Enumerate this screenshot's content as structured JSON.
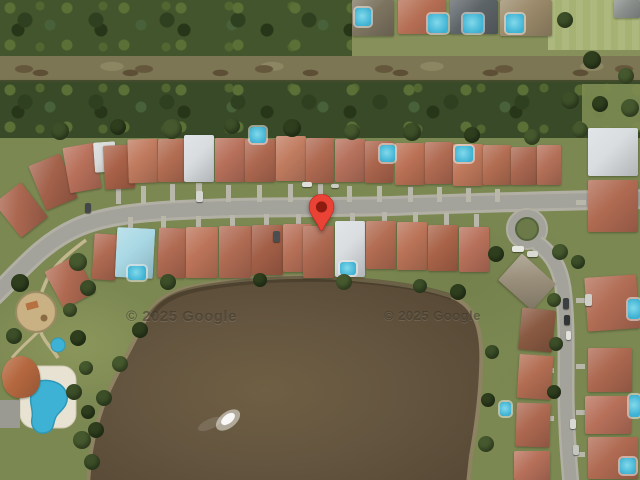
{
  "map": {
    "kind": "google-satellite-view",
    "attribution_left": "© 2025 Google",
    "attribution_right": "© 2025 Google"
  },
  "marker": {
    "name": "location-pin",
    "x": 306,
    "y": 193,
    "width": 31,
    "height": 44,
    "body_color": "#EA4335",
    "outline_color": "#C5221F",
    "dot_color": "#8E1B0F"
  },
  "palette": {
    "grass": "#7c8852",
    "water_mid": "#645540",
    "shore": "#8d8262",
    "road": "#a3a29b",
    "road_edge": "#b2b0a4",
    "driveway": "#b9b6aa",
    "pool": "#3eb2d4",
    "roof_terracotta": "#b06a52",
    "roof_white": "#d9dde0"
  },
  "scene": {
    "houses": [
      [
        4,
        188,
        34,
        44,
        -38,
        "#ab6750"
      ],
      [
        36,
        158,
        34,
        48,
        -22,
        "#a3614a"
      ],
      [
        66,
        145,
        32,
        46,
        -10,
        "#b8705a"
      ],
      [
        94,
        142,
        22,
        30,
        -4,
        "#d6d9d8"
      ],
      [
        104,
        145,
        30,
        44,
        -3,
        "#a96148"
      ],
      [
        128,
        139,
        30,
        44,
        -2,
        "#c07a5e"
      ],
      [
        158,
        139,
        28,
        43,
        0,
        "#b26d52"
      ],
      [
        184,
        135,
        30,
        47,
        0,
        "#d8dcdf"
      ],
      [
        215,
        138,
        30,
        44,
        0,
        "#b7705a"
      ],
      [
        245,
        139,
        30,
        43,
        0,
        "#ad6850"
      ],
      [
        276,
        136,
        30,
        45,
        0,
        "#c17c60"
      ],
      [
        306,
        138,
        28,
        45,
        0,
        "#b06a52"
      ],
      [
        335,
        139,
        30,
        43,
        0,
        "#b5705b"
      ],
      [
        365,
        141,
        28,
        42,
        0,
        "#ab654d"
      ],
      [
        395,
        143,
        30,
        42,
        0,
        "#bb7155"
      ],
      [
        425,
        142,
        28,
        42,
        0,
        "#b06a52"
      ],
      [
        453,
        144,
        30,
        42,
        0,
        "#c0795c"
      ],
      [
        483,
        145,
        28,
        40,
        0,
        "#b26d52"
      ],
      [
        511,
        147,
        26,
        38,
        0,
        "#a96750"
      ],
      [
        537,
        145,
        24,
        40,
        0,
        "#b47058"
      ],
      [
        588,
        128,
        50,
        48,
        0,
        "#d9dde0"
      ],
      [
        93,
        234,
        24,
        46,
        4,
        "#b06a52"
      ],
      [
        116,
        228,
        38,
        50,
        3,
        "#a8d8e4"
      ],
      [
        158,
        228,
        28,
        50,
        2,
        "#b06a52"
      ],
      [
        186,
        227,
        32,
        51,
        0,
        "#bc7459"
      ],
      [
        219,
        226,
        32,
        52,
        0,
        "#b06b53"
      ],
      [
        252,
        225,
        31,
        50,
        0,
        "#a35f47"
      ],
      [
        283,
        224,
        29,
        48,
        0,
        "#b77058"
      ],
      [
        303,
        226,
        31,
        52,
        0,
        "#ad6850"
      ],
      [
        335,
        221,
        30,
        56,
        0,
        "#d9dde0"
      ],
      [
        366,
        221,
        30,
        48,
        0,
        "#b26c52"
      ],
      [
        397,
        222,
        30,
        48,
        0,
        "#ba7357"
      ],
      [
        428,
        225,
        30,
        46,
        0,
        "#a96348"
      ],
      [
        459,
        227,
        30,
        45,
        0,
        "#b7705a"
      ],
      [
        52,
        261,
        36,
        42,
        -28,
        "#b06a52"
      ],
      [
        352,
        0,
        42,
        36,
        0,
        "#7d7460"
      ],
      [
        398,
        0,
        48,
        34,
        0,
        "#b56e54"
      ],
      [
        450,
        0,
        48,
        34,
        0,
        "#5d6468"
      ],
      [
        500,
        0,
        52,
        36,
        0,
        "#9b8a6a"
      ],
      [
        614,
        0,
        26,
        18,
        0,
        "#8a8f8c"
      ],
      [
        588,
        180,
        50,
        52,
        0,
        "#b06a52"
      ],
      [
        586,
        276,
        52,
        54,
        -4,
        "#b26d55"
      ],
      [
        588,
        348,
        44,
        44,
        0,
        "#ad6850"
      ],
      [
        585,
        396,
        46,
        38,
        0,
        "#b7705a"
      ],
      [
        588,
        437,
        50,
        42,
        0,
        "#b06a52"
      ],
      [
        504,
        264,
        46,
        36,
        42,
        "#9a8f7a"
      ],
      [
        520,
        309,
        34,
        42,
        6,
        "#8a5a42"
      ],
      [
        518,
        355,
        34,
        44,
        4,
        "#b26d52"
      ],
      [
        516,
        403,
        34,
        44,
        2,
        "#ad6850"
      ],
      [
        514,
        451,
        36,
        29,
        0,
        "#b7705a"
      ],
      [
        2,
        356,
        38,
        42,
        -8,
        "#b5683f",
        "round"
      ]
    ],
    "pools": [
      [
        250,
        127,
        16,
        16
      ],
      [
        380,
        145,
        15,
        17
      ],
      [
        455,
        146,
        18,
        16
      ],
      [
        340,
        262,
        16,
        13
      ],
      [
        128,
        266,
        18,
        14
      ],
      [
        355,
        8,
        16,
        18
      ],
      [
        428,
        14,
        20,
        19
      ],
      [
        463,
        14,
        20,
        19
      ],
      [
        506,
        14,
        18,
        19
      ],
      [
        628,
        299,
        12,
        20
      ],
      [
        629,
        395,
        11,
        22
      ],
      [
        620,
        458,
        16,
        16
      ],
      [
        500,
        402,
        11,
        14
      ]
    ],
    "trees": [
      [
        60,
        131,
        9
      ],
      [
        118,
        127,
        8
      ],
      [
        172,
        129,
        10
      ],
      [
        232,
        126,
        8
      ],
      [
        292,
        128,
        9
      ],
      [
        352,
        132,
        8
      ],
      [
        412,
        132,
        9
      ],
      [
        472,
        135,
        8
      ],
      [
        532,
        137,
        8
      ],
      [
        168,
        282,
        8
      ],
      [
        260,
        280,
        7
      ],
      [
        344,
        282,
        8
      ],
      [
        420,
        286,
        7
      ],
      [
        458,
        292,
        8
      ],
      [
        78,
        262,
        9
      ],
      [
        88,
        288,
        8
      ],
      [
        20,
        283,
        9
      ],
      [
        70,
        310,
        7
      ],
      [
        14,
        336,
        8
      ],
      [
        78,
        338,
        8
      ],
      [
        86,
        368,
        7
      ],
      [
        74,
        392,
        8
      ],
      [
        88,
        412,
        7
      ],
      [
        82,
        440,
        9
      ],
      [
        92,
        462,
        8
      ],
      [
        140,
        330,
        8
      ],
      [
        120,
        364,
        8
      ],
      [
        104,
        398,
        8
      ],
      [
        96,
        430,
        8
      ],
      [
        560,
        252,
        8
      ],
      [
        578,
        262,
        7
      ],
      [
        496,
        254,
        8
      ],
      [
        554,
        300,
        7
      ],
      [
        556,
        344,
        7
      ],
      [
        554,
        392,
        7
      ],
      [
        580,
        130,
        8
      ],
      [
        570,
        100,
        9
      ],
      [
        600,
        104,
        8
      ],
      [
        630,
        108,
        9
      ],
      [
        565,
        20,
        8
      ],
      [
        592,
        60,
        9
      ],
      [
        626,
        76,
        8
      ],
      [
        492,
        352,
        7
      ],
      [
        488,
        400,
        7
      ],
      [
        486,
        444,
        8
      ]
    ],
    "tree_colors": [
      "#3c4f28",
      "#2f3f1e",
      "#46592e"
    ],
    "cars": [
      [
        196,
        191,
        7,
        11,
        "#d6d6d0"
      ],
      [
        85,
        203,
        6,
        10,
        "#43474a"
      ],
      [
        273,
        231,
        7,
        11,
        "#4a4e50"
      ],
      [
        302,
        182,
        10,
        5,
        "#e0e0da"
      ],
      [
        331,
        184,
        8,
        4,
        "#caccc6"
      ],
      [
        512,
        246,
        12,
        6,
        "#e8e8e2"
      ],
      [
        527,
        251,
        11,
        6,
        "#d9d9d2"
      ],
      [
        563,
        298,
        6,
        11,
        "#3c4042"
      ],
      [
        564,
        315,
        6,
        10,
        "#303436"
      ],
      [
        566,
        331,
        5,
        9,
        "#e2e2dc"
      ],
      [
        585,
        294,
        7,
        12,
        "#cfcfc9"
      ],
      [
        570,
        419,
        6,
        10,
        "#d9d9d3"
      ],
      [
        573,
        445,
        6,
        10,
        "#c6c6c0"
      ]
    ],
    "driveways": [
      [
        116,
        184,
        5,
        20
      ],
      [
        141,
        186,
        5,
        18
      ],
      [
        170,
        184,
        5,
        18
      ],
      [
        196,
        183,
        6,
        19
      ],
      [
        226,
        185,
        5,
        17
      ],
      [
        257,
        185,
        5,
        17
      ],
      [
        288,
        184,
        5,
        18
      ],
      [
        318,
        184,
        5,
        18
      ],
      [
        347,
        186,
        5,
        16
      ],
      [
        377,
        186,
        5,
        16
      ],
      [
        408,
        187,
        5,
        15
      ],
      [
        437,
        187,
        5,
        15
      ],
      [
        466,
        188,
        5,
        14
      ],
      [
        495,
        189,
        5,
        13
      ],
      [
        128,
        217,
        5,
        17
      ],
      [
        161,
        216,
        5,
        14
      ],
      [
        196,
        216,
        5,
        13
      ],
      [
        230,
        215,
        5,
        13
      ],
      [
        264,
        214,
        5,
        12
      ],
      [
        296,
        214,
        5,
        13
      ],
      [
        350,
        213,
        5,
        11
      ],
      [
        382,
        212,
        5,
        12
      ],
      [
        413,
        212,
        5,
        14
      ],
      [
        444,
        213,
        5,
        14
      ],
      [
        474,
        214,
        5,
        14
      ],
      [
        546,
        322,
        8,
        5
      ],
      [
        544,
        368,
        10,
        5
      ],
      [
        542,
        416,
        12,
        5
      ],
      [
        576,
        200,
        10,
        5
      ],
      [
        576,
        298,
        9,
        5
      ],
      [
        576,
        364,
        9,
        5
      ],
      [
        576,
        410,
        9,
        5
      ],
      [
        576,
        452,
        9,
        5
      ]
    ]
  }
}
